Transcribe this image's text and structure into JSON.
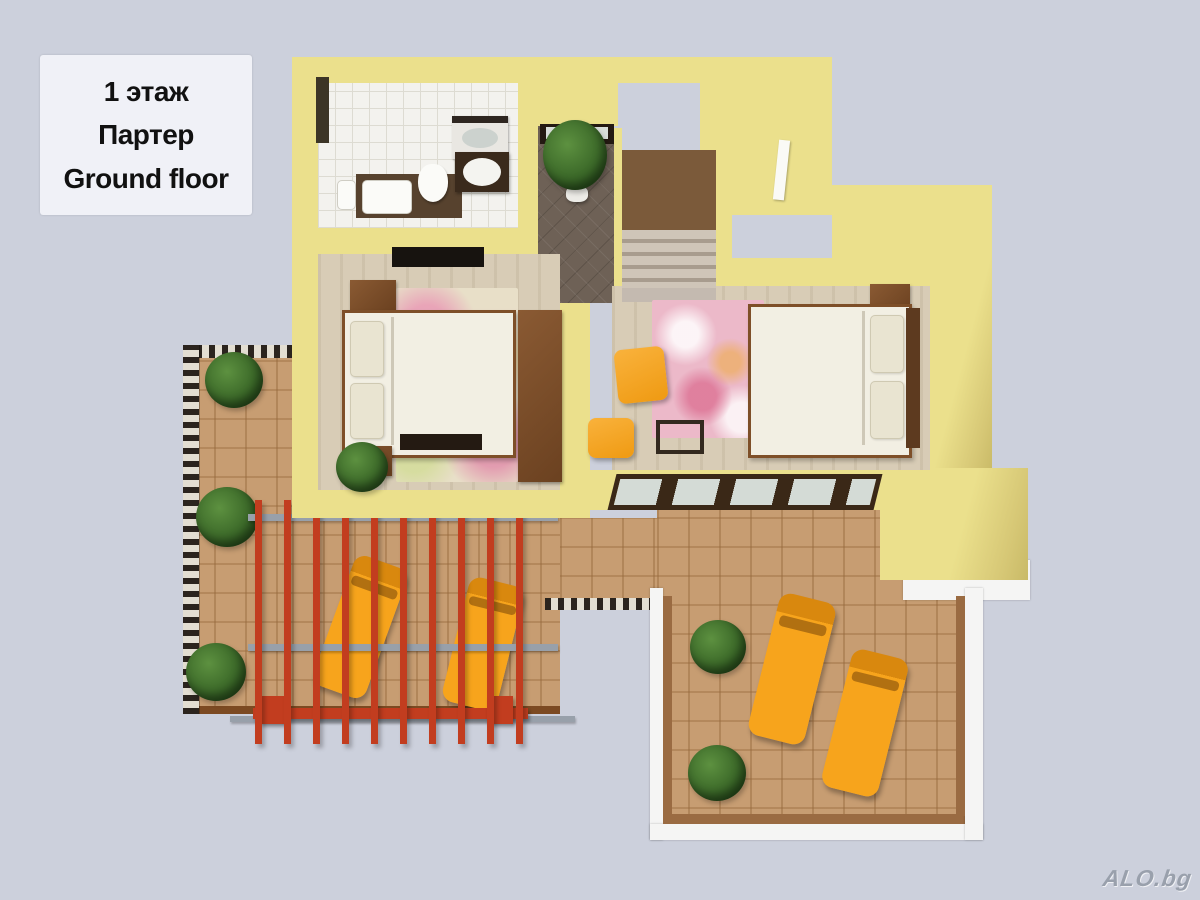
{
  "label": {
    "lines": [
      "1 этаж",
      "Партер",
      "Ground floor"
    ]
  },
  "watermark": {
    "text": "ALO.bg"
  },
  "scene": {
    "type": "3d-floor-plan-render",
    "rooms": [
      "bathroom",
      "entry-hall",
      "staircase",
      "bedroom-left",
      "bedroom-right",
      "terrace-left-with-pergola",
      "terrace-right"
    ]
  },
  "colors": {
    "background": "#ccd0dc",
    "label_bg": "#f0f1f7",
    "label_text": "#111111",
    "watermark": "#99a0ac",
    "wall": "#ebe08c",
    "wall_dark": "#d6c775",
    "bath_floor": "#f3f2ee",
    "bath_grid": "#dddbd2",
    "hall_floor": "#6e6156",
    "bedroom_floor": "#d8ccb6",
    "terrace_tile": "#c79d72",
    "pergola_red": "#c23d1f",
    "beam_gray": "#98a0aa",
    "lounger": "#f7a41c",
    "lounger_dark": "#d9880e",
    "plant_dark": "#2f5a20",
    "plant_light": "#5d9140",
    "wood_color": "#7e4f28",
    "bed_white": "#f2efe3",
    "pillow": "#e9e4d1",
    "rug_pink": "#ecb9c9",
    "parapet": "#f5f5f4",
    "trim_brown": "#9a6b42",
    "railing_dark": "#2b241e",
    "railing_light": "#e3ded2",
    "tv_black": "#17130f",
    "step_light": "#cfc5b8",
    "step_dark": "#a89c8e"
  }
}
